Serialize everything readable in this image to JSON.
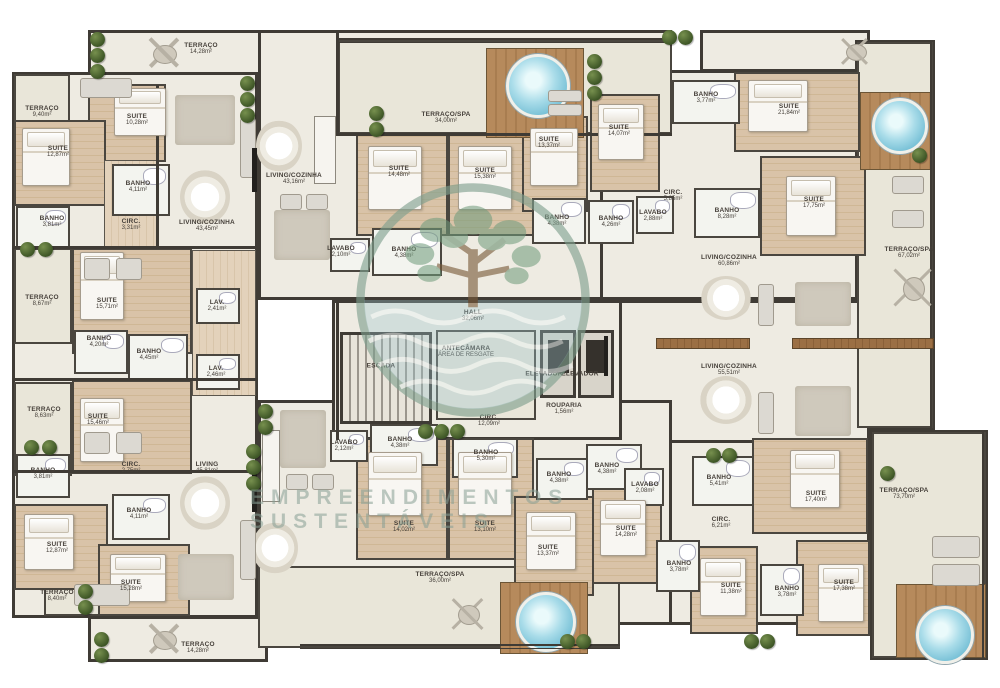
{
  "watermark": {
    "brand": "EMPREENDIMENTOS SUSTENTÁVEIS"
  },
  "rooms": [
    {
      "label": "TERRAÇO",
      "area": "14,28m²"
    },
    {
      "label": "TERRAÇO",
      "area": "9,40m²"
    },
    {
      "label": "SUITE",
      "area": "10,28m²"
    },
    {
      "label": "SUITE",
      "area": "12,87m²"
    },
    {
      "label": "BANHO",
      "area": "4,11m²"
    },
    {
      "label": "BANHO",
      "area": "3,81m²"
    },
    {
      "label": "CIRC.",
      "area": "3,31m²"
    },
    {
      "label": "LIVING/COZINHA",
      "area": "43,45m²"
    },
    {
      "label": "TERRAÇO",
      "area": "8,67m²"
    },
    {
      "label": "SUITE",
      "area": "15,71m²"
    },
    {
      "label": "BANHO",
      "area": "4,20m²"
    },
    {
      "label": "LAV.",
      "area": "2,41m²"
    },
    {
      "label": "BANHO",
      "area": "4,45m²"
    },
    {
      "label": "LAV.",
      "area": "2,46m²"
    },
    {
      "label": "TERRAÇO",
      "area": "8,63m²"
    },
    {
      "label": "SUITE",
      "area": "15,46m²"
    },
    {
      "label": "BANHO",
      "area": "3,81m²"
    },
    {
      "label": "CIRC.",
      "area": "2,75m²"
    },
    {
      "label": "LIVING",
      "area": "45,81m²"
    },
    {
      "label": "SUITE",
      "area": "12,87m²"
    },
    {
      "label": "BANHO",
      "area": "4,11m²"
    },
    {
      "label": "TERRAÇO",
      "area": "8,40m²"
    },
    {
      "label": "SUITE",
      "area": "15,28m²"
    },
    {
      "label": "TERRAÇO",
      "area": "14,28m²"
    },
    {
      "label": "LIVING/COZINHA",
      "area": "43,16m²"
    },
    {
      "label": "TERRAÇO/SPA",
      "area": "34,00m²"
    },
    {
      "label": "LAVABO",
      "area": "2,10m²"
    },
    {
      "label": "SUITE",
      "area": "14,48m²"
    },
    {
      "label": "BANHO",
      "area": "4,38m²"
    },
    {
      "label": "SUITE",
      "area": "15,38m²"
    },
    {
      "label": "BANHO",
      "area": "4,38m²"
    },
    {
      "label": "SUITE",
      "area": "13,37m²"
    },
    {
      "label": "SUITE",
      "area": "14,07m²"
    },
    {
      "label": "BANHO",
      "area": "3,77m²"
    },
    {
      "label": "SUITE",
      "area": "21,84m²"
    },
    {
      "label": "CIRC.",
      "area": "5,85m²"
    },
    {
      "label": "LAVABO",
      "area": "2,88m²"
    },
    {
      "label": "BANHO",
      "area": "4,26m²"
    },
    {
      "label": "BANHO",
      "area": "8,28m²"
    },
    {
      "label": "SUITE",
      "area": "17,75m²"
    },
    {
      "label": "LIVING/COZINHA",
      "area": "60,86m²"
    },
    {
      "label": "TERRAÇO/SPA",
      "area": "67,02m²"
    },
    {
      "label": "LIVING/COZINHA",
      "area": "55,51m²"
    },
    {
      "label": "HALL",
      "area": "32,06m²"
    },
    {
      "label": "ESCADA",
      "area": ""
    },
    {
      "label": "ANTECÂMARA",
      "area": "ÁREA DE RESGATE"
    },
    {
      "label": "ELEVADOR",
      "area": ""
    },
    {
      "label": "ELEVADOR",
      "area": ""
    },
    {
      "label": "ROUPARIA",
      "area": "1,56m²"
    },
    {
      "label": "CIRC.",
      "area": "12,09m²"
    },
    {
      "label": "LAVABO",
      "area": "2,12m²"
    },
    {
      "label": "BANHO",
      "area": "4,38m²"
    },
    {
      "label": "SUITE",
      "area": "14,02m²"
    },
    {
      "label": "BANHO",
      "area": "5,30m²"
    },
    {
      "label": "SUITE",
      "area": "13,10m²"
    },
    {
      "label": "BANHO",
      "area": "4,38m²"
    },
    {
      "label": "SUITE",
      "area": "13,37m²"
    },
    {
      "label": "TERRAÇO/SPA",
      "area": "36,00m²"
    },
    {
      "label": "BANHO",
      "area": "4,38m²"
    },
    {
      "label": "LAVABO",
      "area": "2,08m²"
    },
    {
      "label": "BANHO",
      "area": "5,41m²"
    },
    {
      "label": "CIRC.",
      "area": "6,21m²"
    },
    {
      "label": "SUITE",
      "area": "14,28m²"
    },
    {
      "label": "SUITE",
      "area": "17,40m²"
    },
    {
      "label": "BANHO",
      "area": "3,78m²"
    },
    {
      "label": "SUITE",
      "area": "11,38m²"
    },
    {
      "label": "BANHO",
      "area": "3,78m²"
    },
    {
      "label": "SUITE",
      "area": "17,38m²"
    },
    {
      "label": "TERRAÇO/SPA",
      "area": "73,70m²"
    }
  ]
}
